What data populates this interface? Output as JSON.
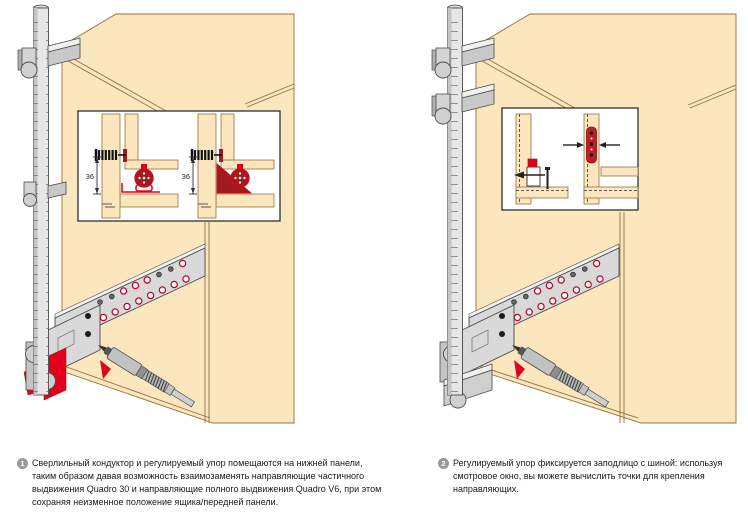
{
  "document": {
    "type": "furniture-hardware-instruction-sheet",
    "language": "ru"
  },
  "colors": {
    "background": "#ffffff",
    "wood": "#FCE6BE",
    "wood_edge": "#8F7442",
    "metal_light": "#E6E6E6",
    "metal_mid": "#C9C9C9",
    "outline": "#4A4A4A",
    "accent_red": "#E2001A",
    "dark_red": "#9E1B1E",
    "inset_border": "#2F2F2F",
    "caption_bullet": "#999999",
    "caption_text": "#1a1a1a"
  },
  "figures": {
    "left": {
      "inset": {
        "dimension_label": "36"
      }
    }
  },
  "captions": [
    {
      "number": "1",
      "lines": [
        "Сверлильный кондуктор и регулируемый упор помещаются на нижней панели,",
        "таким образом давая возможность взаимозаменять направляющие частичного",
        "выдвижения Quadro 30 и направляющие полного выдвижения Quadro V6, при этом",
        "сохраняя неизменное положение ящика/передней панели."
      ]
    },
    {
      "number": "2",
      "lines": [
        "Регулируемый упор фиксируется заподлицо с шиной: используя",
        "смотровое окно, вы можете вычислить точки для крепления",
        "направляющих."
      ]
    }
  ]
}
